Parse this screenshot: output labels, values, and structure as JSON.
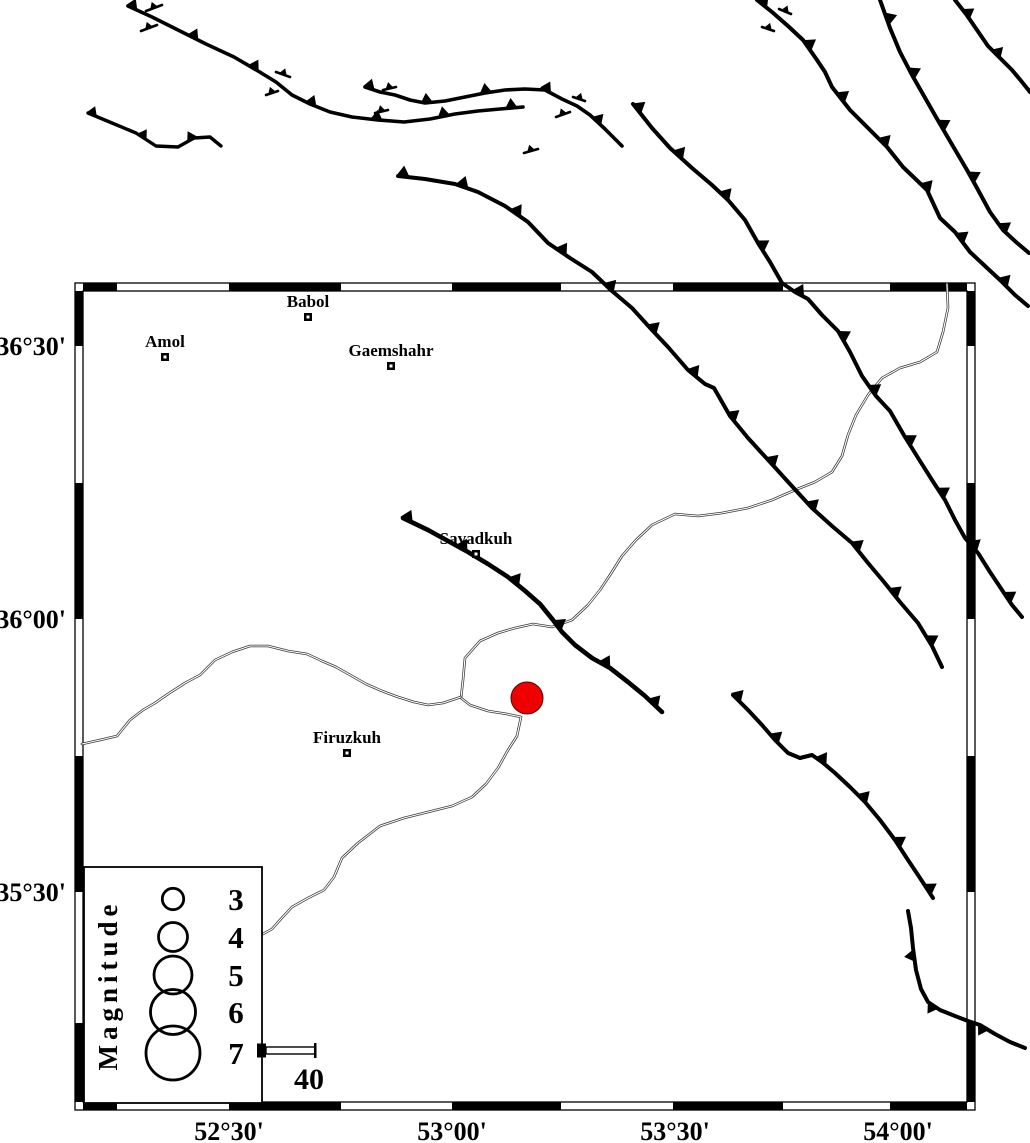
{
  "colors": {
    "background": "#ffffff",
    "ink": "#000000",
    "river": "#3a3a3a",
    "epicenter_fill": "#ee0000",
    "epicenter_stroke": "#550000"
  },
  "frame": {
    "x": 75,
    "y": 283,
    "width": 900,
    "height": 827,
    "band": 8,
    "lon_black_segments": [
      [
        83,
        117
      ],
      [
        229,
        341
      ],
      [
        452,
        561
      ],
      [
        673,
        783
      ],
      [
        890,
        967
      ]
    ],
    "lat_black_segments": [
      [
        291,
        346
      ],
      [
        483,
        619
      ],
      [
        756,
        892
      ],
      [
        1023,
        1102
      ]
    ]
  },
  "axes": {
    "left": [
      {
        "label": "36°30'",
        "y": 346
      },
      {
        "label": "36°00'",
        "y": 619
      },
      {
        "label": "35°30'",
        "y": 892
      }
    ],
    "bottom": [
      {
        "label": "52°30'",
        "x": 229
      },
      {
        "label": "53°00'",
        "x": 452
      },
      {
        "label": "53°30'",
        "x": 675
      },
      {
        "label": "54°00'",
        "x": 898
      }
    ]
  },
  "cities": [
    {
      "name": "Babol",
      "x": 308,
      "y": 317
    },
    {
      "name": "Amol",
      "x": 165,
      "y": 357
    },
    {
      "name": "Gaemshahr",
      "x": 391,
      "y": 366
    },
    {
      "name": "Savadkuh",
      "x": 476,
      "y": 554
    },
    {
      "name": "Firuzkuh",
      "x": 347,
      "y": 753
    }
  ],
  "epicenter": {
    "x": 527,
    "y": 698,
    "r": 16
  },
  "faults": [
    {
      "id": "fault-north-A",
      "w": 3.6,
      "spacing": 68,
      "size": 10,
      "side": "left",
      "phase": 4,
      "points": [
        [
          128,
          6
        ],
        [
          152,
          17
        ],
        [
          180,
          31
        ],
        [
          206,
          44
        ],
        [
          234,
          57
        ],
        [
          258,
          71
        ],
        [
          276,
          82
        ],
        [
          292,
          95
        ],
        [
          310,
          104
        ],
        [
          330,
          112
        ],
        [
          352,
          117
        ],
        [
          378,
          120
        ],
        [
          404,
          122
        ],
        [
          430,
          119
        ],
        [
          455,
          114
        ],
        [
          478,
          111
        ],
        [
          500,
          109
        ],
        [
          523,
          107
        ]
      ]
    },
    {
      "id": "fault-north-B",
      "w": 3.4,
      "spacing": 55,
      "size": 9,
      "side": "left",
      "phase": 4,
      "points": [
        [
          88,
          113
        ],
        [
          112,
          123
        ],
        [
          136,
          133
        ],
        [
          156,
          146
        ],
        [
          178,
          147
        ],
        [
          194,
          138
        ],
        [
          210,
          137
        ],
        [
          221,
          146
        ]
      ]
    },
    {
      "id": "fault-north-C",
      "w": 3.6,
      "spacing": 60,
      "size": 10,
      "side": "left",
      "phase": 4,
      "points": [
        [
          365,
          87
        ],
        [
          380,
          92
        ],
        [
          395,
          95
        ],
        [
          410,
          100
        ],
        [
          425,
          103
        ],
        [
          445,
          101
        ],
        [
          465,
          97
        ],
        [
          485,
          93
        ],
        [
          505,
          90
        ],
        [
          525,
          89
        ],
        [
          545,
          90
        ],
        [
          562,
          99
        ],
        [
          577,
          106
        ],
        [
          590,
          115
        ],
        [
          605,
          129
        ],
        [
          622,
          146
        ]
      ]
    },
    {
      "id": "fault-main-northeast",
      "w": 4,
      "spacing": 60,
      "size": 11,
      "side": "left",
      "phase": 5,
      "points": [
        [
          398,
          176
        ],
        [
          425,
          179
        ],
        [
          455,
          184
        ],
        [
          478,
          192
        ],
        [
          505,
          206
        ],
        [
          528,
          222
        ],
        [
          548,
          243
        ],
        [
          570,
          258
        ],
        [
          592,
          272
        ],
        [
          612,
          291
        ],
        [
          632,
          308
        ],
        [
          652,
          330
        ],
        [
          668,
          347
        ],
        [
          688,
          370
        ],
        [
          705,
          384
        ],
        [
          714,
          388
        ],
        [
          730,
          416
        ],
        [
          748,
          438
        ],
        [
          770,
          462
        ],
        [
          790,
          484
        ],
        [
          812,
          508
        ],
        [
          832,
          526
        ],
        [
          852,
          543
        ],
        [
          868,
          563
        ],
        [
          884,
          582
        ],
        [
          900,
          602
        ],
        [
          918,
          623
        ],
        [
          932,
          646
        ],
        [
          942,
          667
        ]
      ]
    },
    {
      "id": "fault-east-long",
      "w": 4,
      "spacing": 62,
      "size": 11,
      "side": "left",
      "phase": 6,
      "points": [
        [
          633,
          104
        ],
        [
          652,
          128
        ],
        [
          670,
          148
        ],
        [
          692,
          168
        ],
        [
          712,
          185
        ],
        [
          728,
          200
        ],
        [
          745,
          220
        ],
        [
          758,
          243
        ],
        [
          770,
          262
        ],
        [
          782,
          283
        ],
        [
          795,
          292
        ],
        [
          808,
          299
        ],
        [
          822,
          315
        ],
        [
          838,
          331
        ],
        [
          850,
          352
        ],
        [
          862,
          376
        ],
        [
          876,
          396
        ],
        [
          890,
          411
        ],
        [
          905,
          437
        ],
        [
          920,
          461
        ],
        [
          932,
          480
        ],
        [
          945,
          500
        ],
        [
          955,
          520
        ],
        [
          965,
          538
        ],
        [
          978,
          553
        ],
        [
          990,
          572
        ],
        [
          1002,
          590
        ],
        [
          1012,
          605
        ],
        [
          1022,
          617
        ]
      ]
    },
    {
      "id": "fault-topright-1",
      "w": 4,
      "spacing": 62,
      "size": 11,
      "side": "left",
      "phase": 6,
      "points": [
        [
          757,
          0
        ],
        [
          772,
          12
        ],
        [
          788,
          26
        ],
        [
          803,
          40
        ],
        [
          817,
          60
        ],
        [
          825,
          72
        ],
        [
          832,
          87
        ],
        [
          850,
          110
        ],
        [
          870,
          130
        ],
        [
          887,
          147
        ],
        [
          903,
          167
        ],
        [
          927,
          190
        ],
        [
          940,
          218
        ],
        [
          955,
          232
        ],
        [
          970,
          252
        ],
        [
          985,
          266
        ],
        [
          1000,
          280
        ],
        [
          1015,
          295
        ],
        [
          1028,
          306
        ]
      ]
    },
    {
      "id": "fault-topright-2",
      "w": 4,
      "spacing": 60,
      "size": 11,
      "side": "left",
      "phase": 20,
      "points": [
        [
          880,
          0
        ],
        [
          890,
          28
        ],
        [
          900,
          52
        ],
        [
          912,
          75
        ],
        [
          924,
          96
        ],
        [
          936,
          117
        ],
        [
          947,
          136
        ],
        [
          957,
          153
        ],
        [
          967,
          170
        ],
        [
          977,
          188
        ],
        [
          990,
          212
        ],
        [
          1003,
          230
        ],
        [
          1016,
          242
        ],
        [
          1029,
          253
        ]
      ]
    },
    {
      "id": "fault-topright-3",
      "w": 4,
      "spacing": 50,
      "size": 10,
      "side": "left",
      "phase": 18,
      "points": [
        [
          955,
          0
        ],
        [
          966,
          14
        ],
        [
          977,
          30
        ],
        [
          988,
          46
        ],
        [
          1000,
          58
        ],
        [
          1012,
          70
        ],
        [
          1022,
          82
        ],
        [
          1030,
          92
        ]
      ]
    },
    {
      "id": "fault-savadkuh",
      "w": 4.6,
      "spacing": 62,
      "size": 11,
      "side": "left",
      "phase": 4,
      "points": [
        [
          403,
          518
        ],
        [
          428,
          530
        ],
        [
          448,
          541
        ],
        [
          468,
          552
        ],
        [
          488,
          564
        ],
        [
          508,
          577
        ],
        [
          524,
          590
        ],
        [
          540,
          604
        ],
        [
          553,
          620
        ],
        [
          562,
          632
        ],
        [
          575,
          645
        ],
        [
          592,
          658
        ],
        [
          610,
          668
        ],
        [
          628,
          682
        ],
        [
          645,
          696
        ],
        [
          662,
          712
        ]
      ]
    },
    {
      "id": "fault-southeast",
      "w": 4,
      "spacing": 56,
      "size": 11,
      "side": "left",
      "phase": 4,
      "points": [
        [
          733,
          695
        ],
        [
          748,
          710
        ],
        [
          762,
          725
        ],
        [
          775,
          740
        ],
        [
          788,
          753
        ],
        [
          800,
          758
        ],
        [
          812,
          755
        ],
        [
          822,
          762
        ],
        [
          835,
          773
        ],
        [
          850,
          787
        ],
        [
          865,
          802
        ],
        [
          880,
          820
        ],
        [
          895,
          840
        ],
        [
          908,
          860
        ],
        [
          920,
          878
        ],
        [
          933,
          898
        ]
      ]
    },
    {
      "id": "fault-bottomright",
      "w": 4,
      "spacing": 55,
      "size": 10,
      "side": "right",
      "phase": 45,
      "points": [
        [
          908,
          911
        ],
        [
          911,
          928
        ],
        [
          913,
          948
        ],
        [
          916,
          970
        ],
        [
          921,
          989
        ],
        [
          928,
          1002
        ],
        [
          940,
          1010
        ],
        [
          955,
          1016
        ],
        [
          968,
          1021
        ],
        [
          980,
          1025
        ],
        [
          995,
          1034
        ],
        [
          1010,
          1042
        ],
        [
          1025,
          1048
        ]
      ]
    }
  ],
  "fault_marks": [
    {
      "points": [
        [
          146,
          11
        ],
        [
          162,
          5
        ]
      ]
    },
    {
      "points": [
        [
          141,
          31
        ],
        [
          157,
          25
        ]
      ]
    },
    {
      "points": [
        [
          266,
          95
        ],
        [
          278,
          91
        ]
      ]
    },
    {
      "points": [
        [
          276,
          72
        ],
        [
          290,
          77
        ]
      ]
    },
    {
      "points": [
        [
          383,
          90
        ],
        [
          396,
          87
        ]
      ]
    },
    {
      "points": [
        [
          375,
          113
        ],
        [
          388,
          110
        ]
      ]
    },
    {
      "points": [
        [
          573,
          97
        ],
        [
          585,
          101
        ]
      ]
    },
    {
      "points": [
        [
          556,
          117
        ],
        [
          570,
          112
        ]
      ]
    },
    {
      "points": [
        [
          524,
          153
        ],
        [
          538,
          149
        ]
      ]
    },
    {
      "points": [
        [
          779,
          9
        ],
        [
          791,
          14
        ]
      ]
    },
    {
      "points": [
        [
          762,
          27
        ],
        [
          774,
          31
        ]
      ]
    }
  ],
  "rivers": [
    {
      "id": "river-northeast",
      "points": [
        [
          947,
          284
        ],
        [
          948,
          308
        ],
        [
          943,
          332
        ],
        [
          937,
          352
        ],
        [
          920,
          362
        ],
        [
          900,
          368
        ],
        [
          882,
          378
        ],
        [
          868,
          395
        ],
        [
          856,
          415
        ],
        [
          848,
          435
        ],
        [
          842,
          456
        ],
        [
          832,
          472
        ],
        [
          815,
          482
        ],
        [
          795,
          490
        ],
        [
          772,
          500
        ],
        [
          748,
          508
        ],
        [
          722,
          513
        ],
        [
          698,
          516
        ],
        [
          675,
          514
        ],
        [
          652,
          525
        ],
        [
          636,
          540
        ],
        [
          622,
          556
        ],
        [
          610,
          575
        ],
        [
          600,
          590
        ],
        [
          588,
          605
        ],
        [
          572,
          620
        ],
        [
          552,
          627
        ],
        [
          533,
          624
        ],
        [
          515,
          628
        ],
        [
          498,
          633
        ],
        [
          480,
          641
        ],
        [
          465,
          658
        ],
        [
          463,
          680
        ],
        [
          461,
          698
        ],
        [
          470,
          705
        ],
        [
          488,
          711
        ],
        [
          507,
          714
        ],
        [
          521,
          717
        ],
        [
          517,
          736
        ],
        [
          508,
          750
        ],
        [
          498,
          768
        ],
        [
          486,
          784
        ],
        [
          472,
          797
        ],
        [
          452,
          806
        ],
        [
          428,
          812
        ],
        [
          404,
          818
        ],
        [
          380,
          826
        ],
        [
          358,
          843
        ],
        [
          342,
          858
        ],
        [
          334,
          877
        ],
        [
          324,
          890
        ],
        [
          308,
          898
        ],
        [
          292,
          907
        ],
        [
          280,
          920
        ],
        [
          272,
          929
        ],
        [
          263,
          934
        ]
      ]
    },
    {
      "id": "river-west",
      "points": [
        [
          82,
          744
        ],
        [
          100,
          740
        ],
        [
          117,
          736
        ],
        [
          130,
          720
        ],
        [
          143,
          710
        ],
        [
          155,
          703
        ],
        [
          168,
          694
        ],
        [
          185,
          683
        ],
        [
          200,
          675
        ],
        [
          215,
          660
        ],
        [
          232,
          652
        ],
        [
          250,
          646
        ],
        [
          268,
          646
        ],
        [
          288,
          651
        ],
        [
          307,
          654
        ],
        [
          322,
          661
        ],
        [
          336,
          667
        ],
        [
          352,
          676
        ],
        [
          366,
          684
        ],
        [
          382,
          691
        ],
        [
          398,
          697
        ],
        [
          414,
          702
        ],
        [
          428,
          705
        ],
        [
          443,
          703
        ],
        [
          455,
          699
        ],
        [
          461,
          697
        ]
      ]
    }
  ],
  "legend": {
    "title": "Magnitude",
    "box": {
      "x": 84,
      "y": 867,
      "w": 178,
      "h": 236
    },
    "circle_cx": 173,
    "label_x": 236,
    "items": [
      {
        "mag": "3",
        "cy": 899,
        "r": 10.7
      },
      {
        "mag": "4",
        "cy": 937,
        "r": 14.5
      },
      {
        "mag": "5",
        "cy": 975,
        "r": 19
      },
      {
        "mag": "6",
        "cy": 1012,
        "r": 22.5
      },
      {
        "mag": "7",
        "cy": 1053,
        "r": 27
      }
    ],
    "scale_bar": {
      "label": "40",
      "x1": 258,
      "x2": 315,
      "y": 1047,
      "h": 7
    }
  }
}
